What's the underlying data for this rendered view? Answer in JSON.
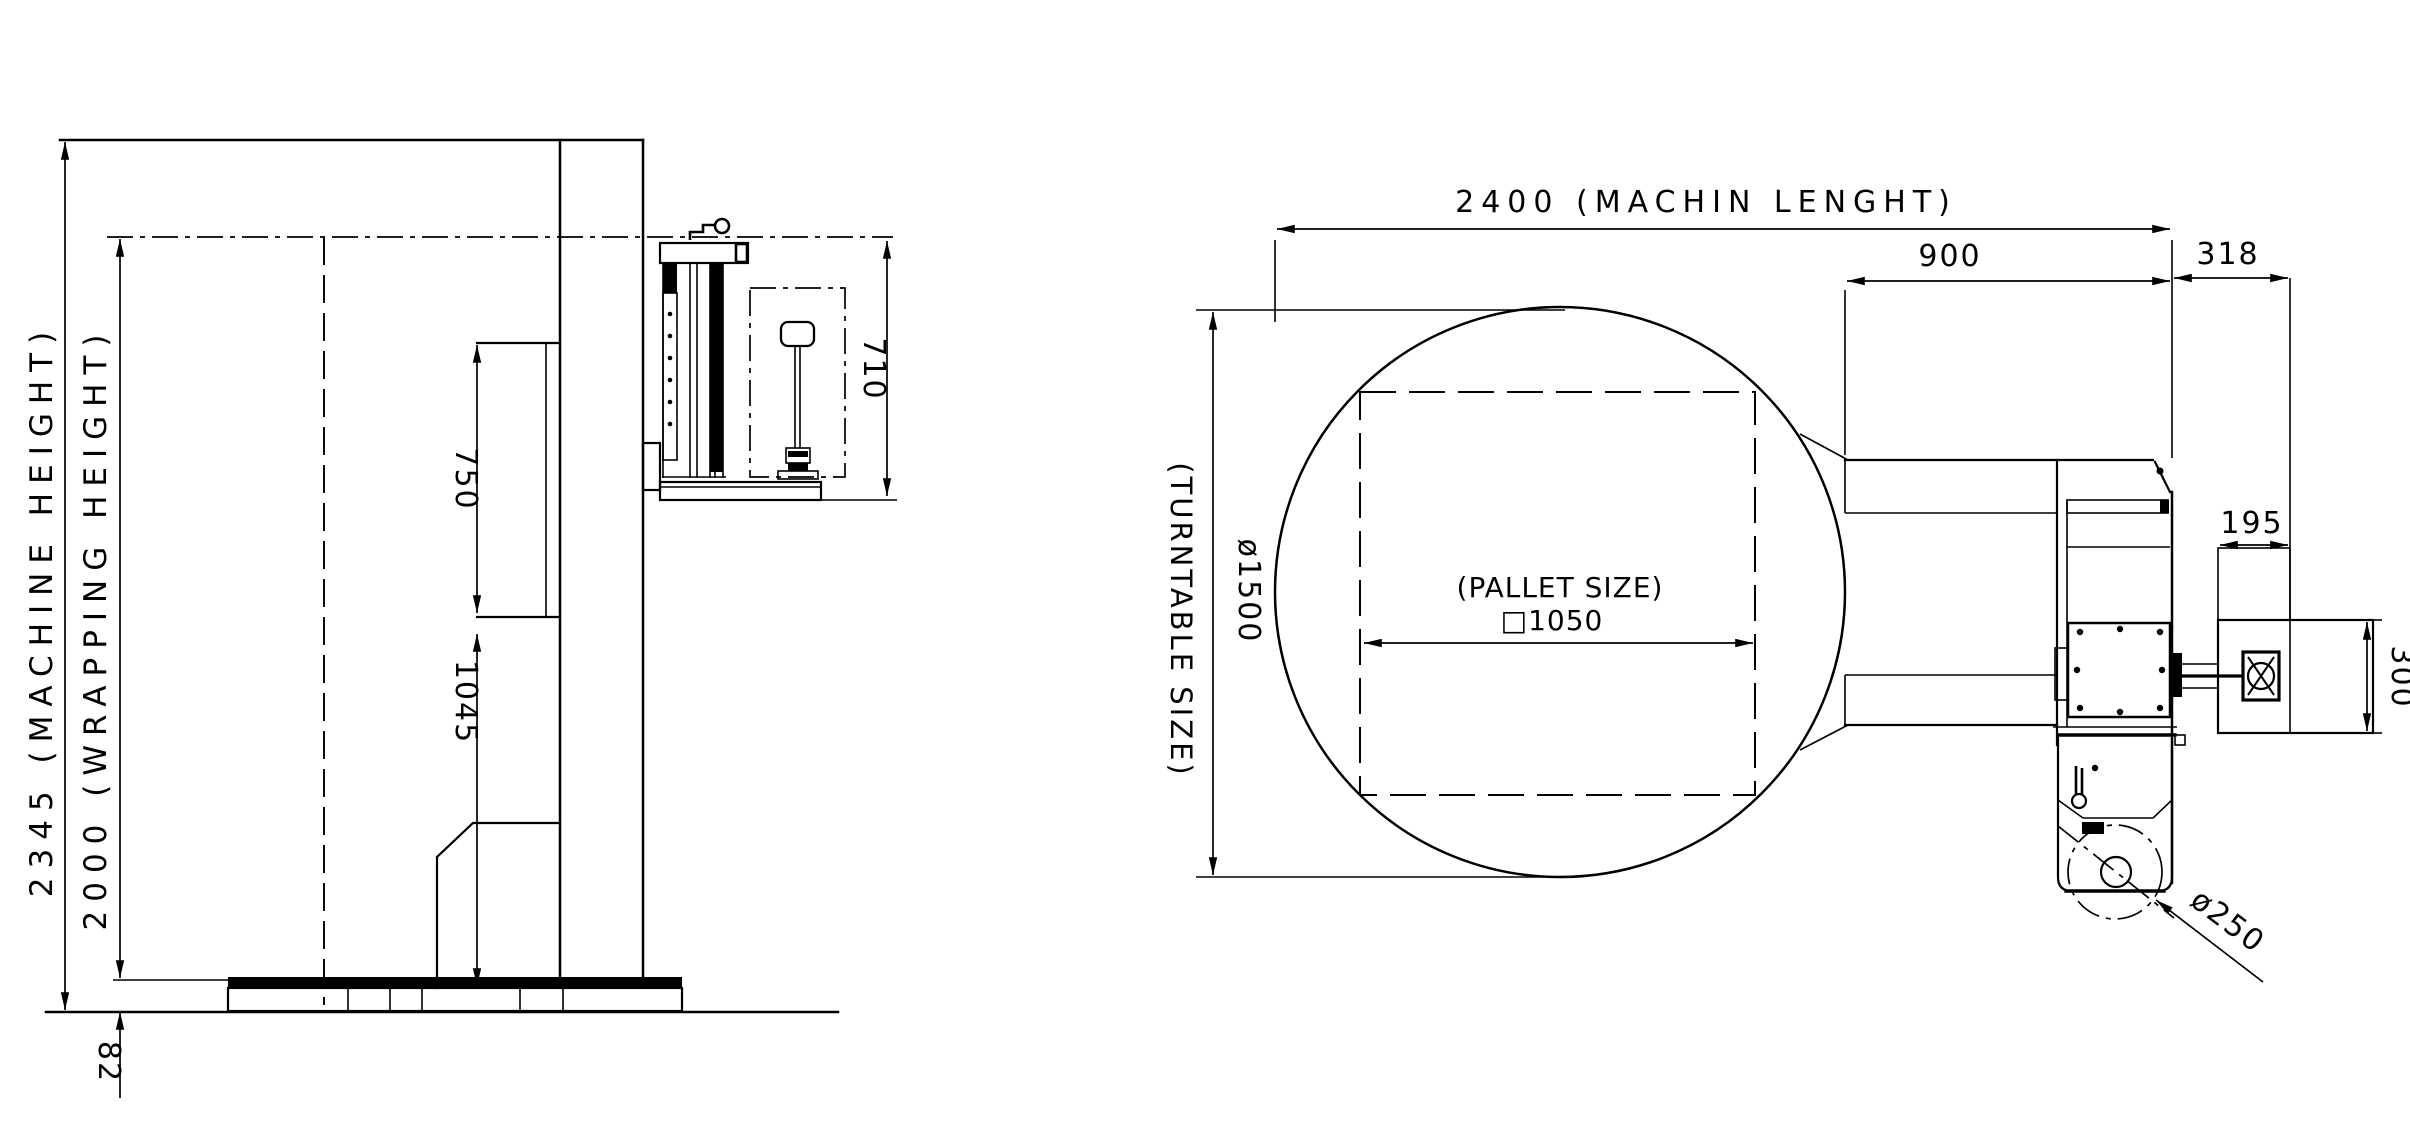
{
  "side_view": {
    "dims": {
      "machine_height": "2345 (MACHINE HEIGHT)",
      "wrapping_height": "2000 (WRAPPING HEIGHT)",
      "carriage_travel": "750",
      "column_lower_section": "1045",
      "film_carriage_height": "710",
      "turntable_base_height": "82"
    }
  },
  "plan_view": {
    "dims": {
      "machine_length": "2400 (MACHIN LENGHT)",
      "turntable_to_rear": "900",
      "rear_overhang": "318",
      "turntable_size_label": "(TURNTABLE SIZE)",
      "turntable_diameter": "ø1500",
      "pallet_size_label": "(PALLET SIZE)",
      "pallet_size": "□1050",
      "film_box_width": "195",
      "film_box_depth": "300",
      "film_roll_diameter": "ø250"
    }
  },
  "colors": {
    "ink": "#000000",
    "paper": "#ffffff"
  }
}
